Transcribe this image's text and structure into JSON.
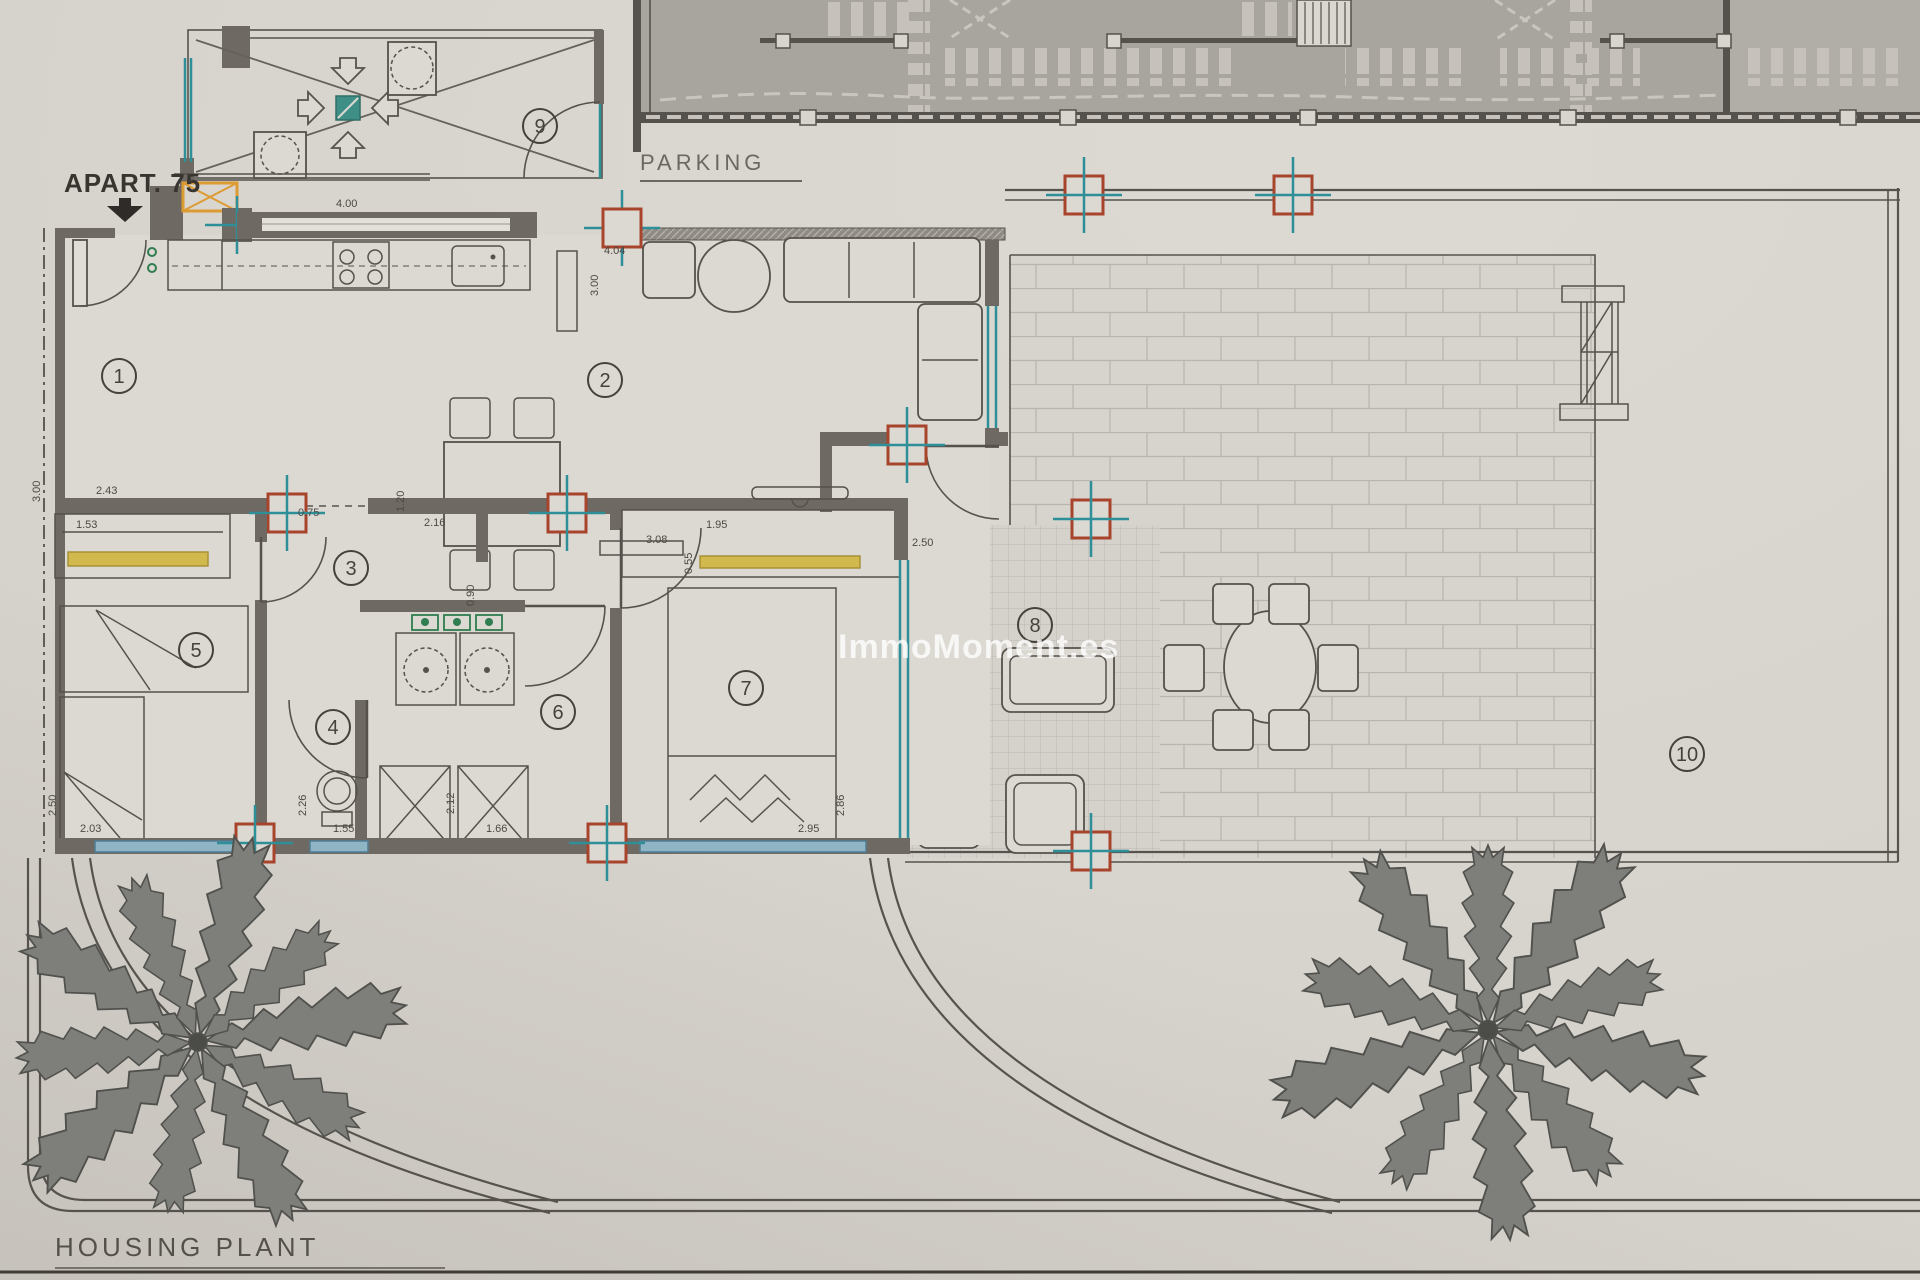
{
  "labels": {
    "apartment": "APART. 75",
    "parking": "PARKING",
    "plan_title": "HOUSING PLANT"
  },
  "watermark": "ImmoMoment.es",
  "rooms": [
    "1",
    "2",
    "3",
    "4",
    "5",
    "6",
    "7",
    "8",
    "9",
    "10"
  ],
  "dimensions": [
    "4.00",
    "4.04",
    "3.00",
    "3.00",
    "2.43",
    "1.53",
    "0.75",
    "1.20",
    "2.16",
    "1.95",
    "3.08",
    "0.55",
    "2.50",
    "0.90",
    "2.50",
    "2.03",
    "2.26",
    "1.55",
    "2.12",
    "1.66",
    "2.95",
    "2.86"
  ],
  "colors": {
    "paper": "#d6d2cc",
    "wall": "#6e6963",
    "parking_fill": "#a8a49e",
    "window_teal": "#2f8f98",
    "pillar_red": "#a8432c",
    "closet_yellow": "#d2b94d",
    "shaft_orange": "#dd9b33",
    "window_blue": "#8fb4c4",
    "drain_green": "#3e8f86",
    "fixture_green": "#2f7d50"
  }
}
